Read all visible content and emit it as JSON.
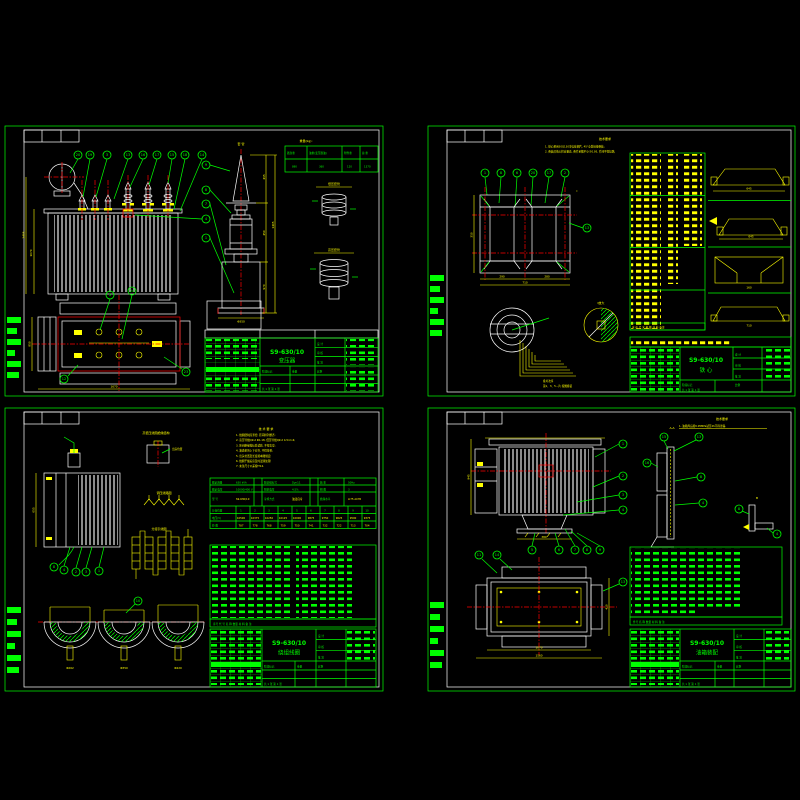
{
  "canvas": {
    "width": 800,
    "height": 800,
    "background": "#000000"
  },
  "colors": {
    "line_green": "#00ff00",
    "line_white": "#ffffff",
    "line_yellow": "#ffff00",
    "line_red": "#ff0000"
  },
  "title_block_labels": {
    "design": "设 计",
    "check": "审 核",
    "approve": "批 准",
    "stage": "阶段标记",
    "weight": "重量",
    "scale": "比例",
    "sheet_count": "共 1 张  第 1 张"
  },
  "sheets": {
    "outline": {
      "position": "top-left",
      "drawing_no": "S9-630/10",
      "drawing_title": "变压器",
      "weight_table": {
        "caption": "重量(kg):",
        "headers": [
          "器身重",
          "油重(变压器油)",
          "附件重",
          "总 重"
        ],
        "values": [
          "890",
          "360",
          "120",
          "1370"
        ]
      },
      "captions": {
        "bushing_detail": "套 管",
        "lv_bushing": "低压套管",
        "hv_bushing": "高压套管"
      },
      "dims": {
        "front_height": "1070",
        "total_height": "1405",
        "bushing_d1": "415",
        "bushing_d2": "450",
        "bushing_d3": "970",
        "bushing_total": "1405",
        "bushing_dia": "Φ350",
        "plan_width": "1670",
        "plan_depth": "850"
      },
      "balloons_top": [
        "20",
        "19",
        "3",
        "13",
        "16",
        "17",
        "15",
        "18",
        "14"
      ],
      "balloons_right": [
        "9",
        "8",
        "7",
        "4",
        "1"
      ],
      "balloons_plan": [
        "5",
        "24",
        "12",
        "23"
      ]
    },
    "core": {
      "position": "top-right",
      "drawing_no": "S9-630/10",
      "drawing_title": "铁 心",
      "notes": {
        "title": "技术要求",
        "lines": [
          "1. 铁心采用30Q130冷轧硅钢片, 45°全斜接缝叠装;",
          "2. 叠装后铁心柱应垂直, 叠片系数不小于0.95, 片间不得短路."
        ]
      },
      "balloons_top": [
        "1",
        "8",
        "6",
        "20",
        "17",
        "2"
      ],
      "balloon_side": "13",
      "section_mark": "Ⅰ",
      "dims": {
        "window_a": "290",
        "window_b": "280",
        "width_total": "710",
        "height": "310",
        "d1": "645",
        "d2": "645",
        "d3": "160",
        "d4": "710"
      },
      "lamination": {
        "caption": "叠片次序",
        "note": "第1、3、5…片 按图叠装"
      },
      "zoom_caption": "Ⅰ放大",
      "bom_header": "序 代 号  名  称  数 材 料 备注"
    },
    "winding": {
      "position": "bottom-left",
      "drawing_no": "S9-630/10",
      "drawing_title": "绕组线圈",
      "top_caption": "高低压线圈绝缘结构",
      "lead_caption": "出头位置",
      "reg_caption": "调压线路图",
      "tap_caption": "分接引线图",
      "notes": {
        "title": "技 术 要 求",
        "lines": [
          "1. 线圈绕制应紧密, 匝间排列整齐;",
          "2. 高压导线QZ-2 Φ1.18, 低压导线QZ-2 4.5×1.6;",
          "3. 匝间绝缘按标准试验, 不得击穿;",
          "4. 油道垫块上下对齐, 不得位移;",
          "5. 出头位置及长度按本图规定;",
          "6. 线圈干燥后应及时浸漆处理;",
          "7. 未注尺寸公差按IT14."
        ]
      },
      "spec": {
        "row1": [
          "额定容量",
          "630 kVA",
          "联结组标号",
          "Dyn11",
          "频 率",
          "50Hz"
        ],
        "row2": [
          "额定电压",
          "10000/400 V",
          "阻抗电压",
          "4.5%",
          "相 数",
          "3"
        ],
        "row3": [
          "型 号",
          "S9-630/10",
          "冷却方式",
          "油浸自冷",
          "绝缘水平",
          "LI75 AC35"
        ],
        "tap_label": "分接位置",
        "tap_cells": [
          "1",
          "2",
          "3",
          "4",
          "5",
          "6",
          "7",
          "8",
          "9",
          "10"
        ],
        "volt_label": "电压(V)",
        "volt_cells": [
          "10500",
          "10375",
          "10250",
          "10125",
          "10000",
          "9875",
          "9750",
          "9625",
          "9500",
          "9375"
        ],
        "turn_label": "匝 数",
        "turn_cells": [
          "787",
          "778",
          "768",
          "759",
          "750",
          "741",
          "732",
          "722",
          "713",
          "704"
        ]
      },
      "bom_header": "序号 代 号  名  称  数量 材 料 备 注",
      "balloons": [
        "8",
        "4",
        "2",
        "3",
        "1"
      ],
      "balloon_coil": "10",
      "dims": {
        "winding_h": "655",
        "coil1": "Φ262",
        "coil2": "Φ350",
        "coil3": "Φ420"
      }
    },
    "tank": {
      "position": "bottom-right",
      "drawing_no": "S9-630/10",
      "drawing_title": "油箱装配",
      "notes": {
        "title": "技术要求",
        "lines": [
          "1. 油箱焊后按0.05MPa试压2h不得渗漏."
        ]
      },
      "captions": {
        "section_aa": "A-A",
        "detail_b": "B"
      },
      "balloons_right": [
        "1",
        "2",
        "3",
        "4"
      ],
      "balloons_bottom": [
        "5",
        "6",
        "7",
        "8",
        "9"
      ],
      "balloons_plan": [
        "11",
        "14",
        "13"
      ],
      "balloons_aa": [
        "15",
        "13",
        "16",
        "8",
        "4"
      ],
      "balloons_b": [
        "8",
        "4"
      ],
      "dims": {
        "height": "945",
        "base_w": "380",
        "plan_w": "1560",
        "plan_inner_w": "1070",
        "plan_d": "420"
      },
      "bom_header": "件号 名 称 数量 材 料 备 注"
    }
  }
}
